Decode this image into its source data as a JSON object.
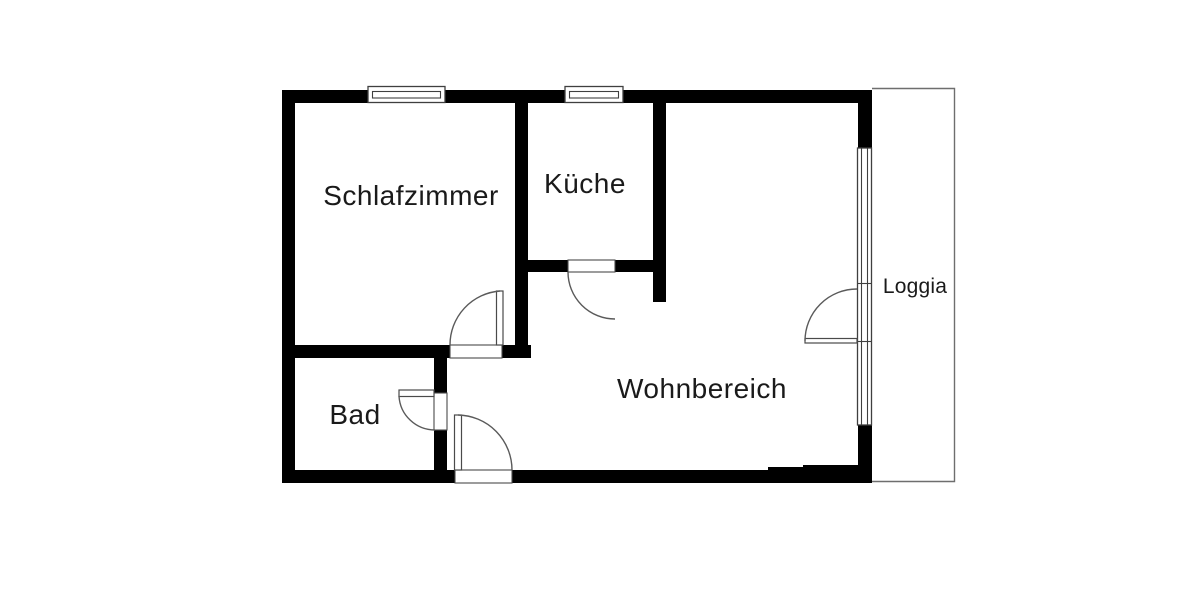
{
  "floorplan": {
    "type": "apartment-floor-plan",
    "rooms": [
      {
        "id": "schlafzimmer",
        "label": "Schlafzimmer"
      },
      {
        "id": "kueche",
        "label": "Küche"
      },
      {
        "id": "bad",
        "label": "Bad"
      },
      {
        "id": "wohnbereich",
        "label": "Wohnbereich"
      },
      {
        "id": "loggia",
        "label": "Loggia"
      }
    ],
    "colors": {
      "wall": "#000000",
      "thin_line": "#4a4a4a",
      "loggia_line": "#6e6e6e",
      "text": "#1a1a1a",
      "background": "#ffffff"
    }
  }
}
